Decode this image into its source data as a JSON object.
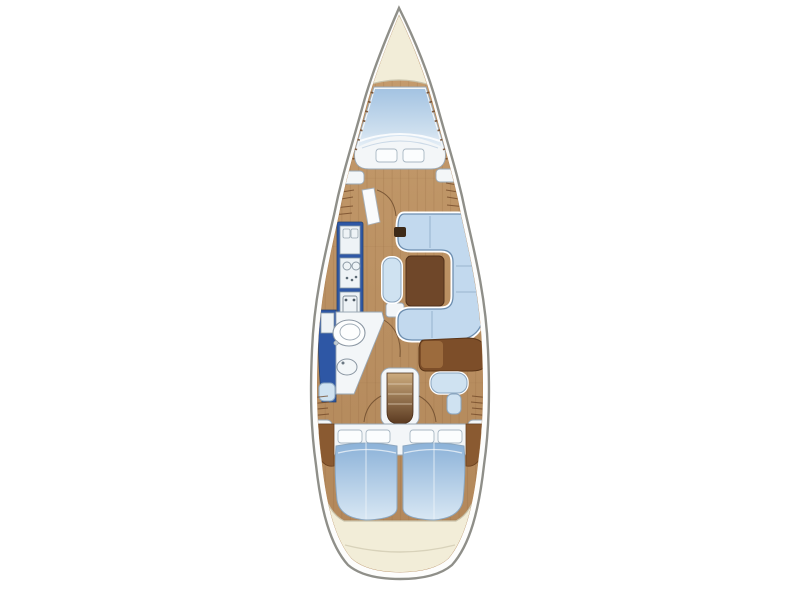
{
  "page": {
    "kind": "yacht-interior-floorplan",
    "view": "top-down",
    "background": "#ffffff"
  },
  "palette": {
    "hull-outline": "#8f8f89",
    "hull-fill": "#fdfdfc",
    "deck-cream": "#f2edd8",
    "deck-edge": "#c9c3ab",
    "wood-light": "#c69d6e",
    "wood-dark": "#b2875a",
    "wood-line": "#8a6038",
    "trim-tick": "#6f4526",
    "berth-blue-deep": "#a3c3e2",
    "berth-blue-pale": "#e6eff7",
    "bed-blue-deep": "#8ab1d8",
    "bed-blue-pale": "#d9e8f4",
    "cushion-blue": "#c2d9ee",
    "cushion-rim": "#ffffff",
    "cushion-outline": "#6e8fb0",
    "upholstery-white": "#f3f6f8",
    "galley-blue": "#2e57a5",
    "appliance-white": "#eef3f6",
    "table-brown": "#6f4729",
    "desk-brown": "#7d4e29",
    "desk-highlight": "#a06f3f",
    "step-light": "#cfae80",
    "step-dark": "#58371e",
    "outline-gray": "#9aa8b5"
  },
  "areas": [
    "bow-deck",
    "v-berth-cabin",
    "side-lockers",
    "galley",
    "head-compartment",
    "salon-settee",
    "salon-table",
    "nav-station",
    "companionway-steps",
    "aft-cabin-port",
    "aft-cabin-starboard",
    "stern-deck"
  ]
}
